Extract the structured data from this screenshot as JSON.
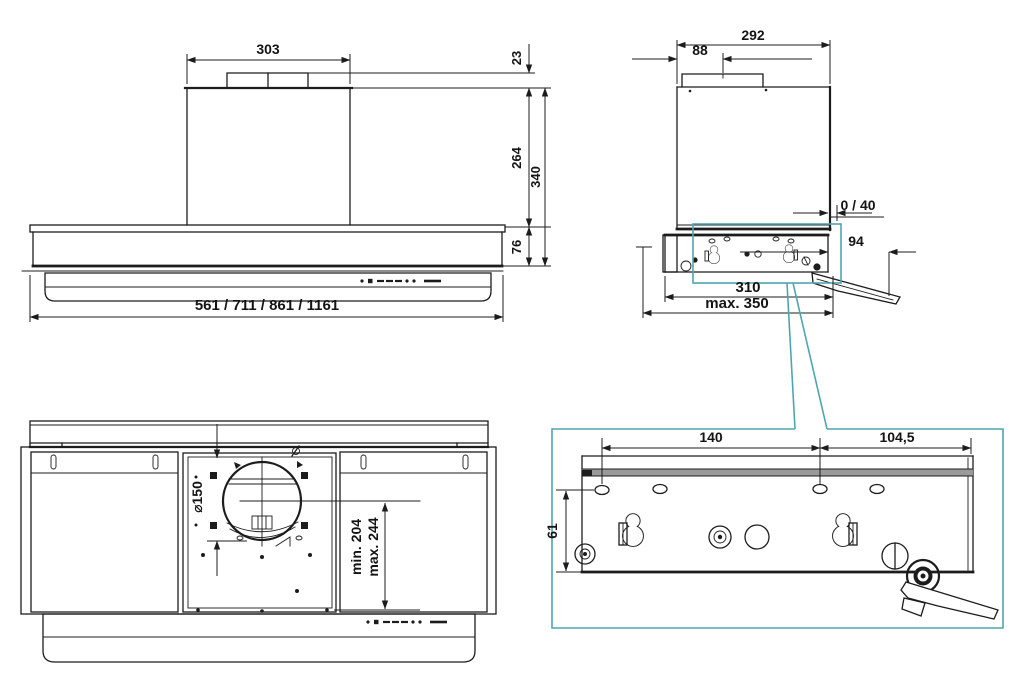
{
  "colors": {
    "line": "#1c1c1c",
    "detail_highlight_teal": "#4da6af",
    "mounting_rail_gray": "#9a9a9a",
    "background": "#ffffff"
  },
  "front_view": {
    "duct_width": "303",
    "connector_height": "23",
    "chimney_height": "264",
    "total_height": "340",
    "body_height": "76",
    "available_widths": "561 / 711 / 861 / 1161"
  },
  "side_view": {
    "depth": "292",
    "duct_offset": "88",
    "wall_clearance": "0 / 40",
    "bracket_extension": "94",
    "plate_depth": "310",
    "max_depth": "max. 350"
  },
  "bottom_view": {
    "duct_diameter": "⌀150",
    "min_height": "min. 204",
    "max_height": "max. 244"
  },
  "detail_view": {
    "hole_spacing": "140",
    "edge_offset": "104,5",
    "plate_height": "61"
  }
}
